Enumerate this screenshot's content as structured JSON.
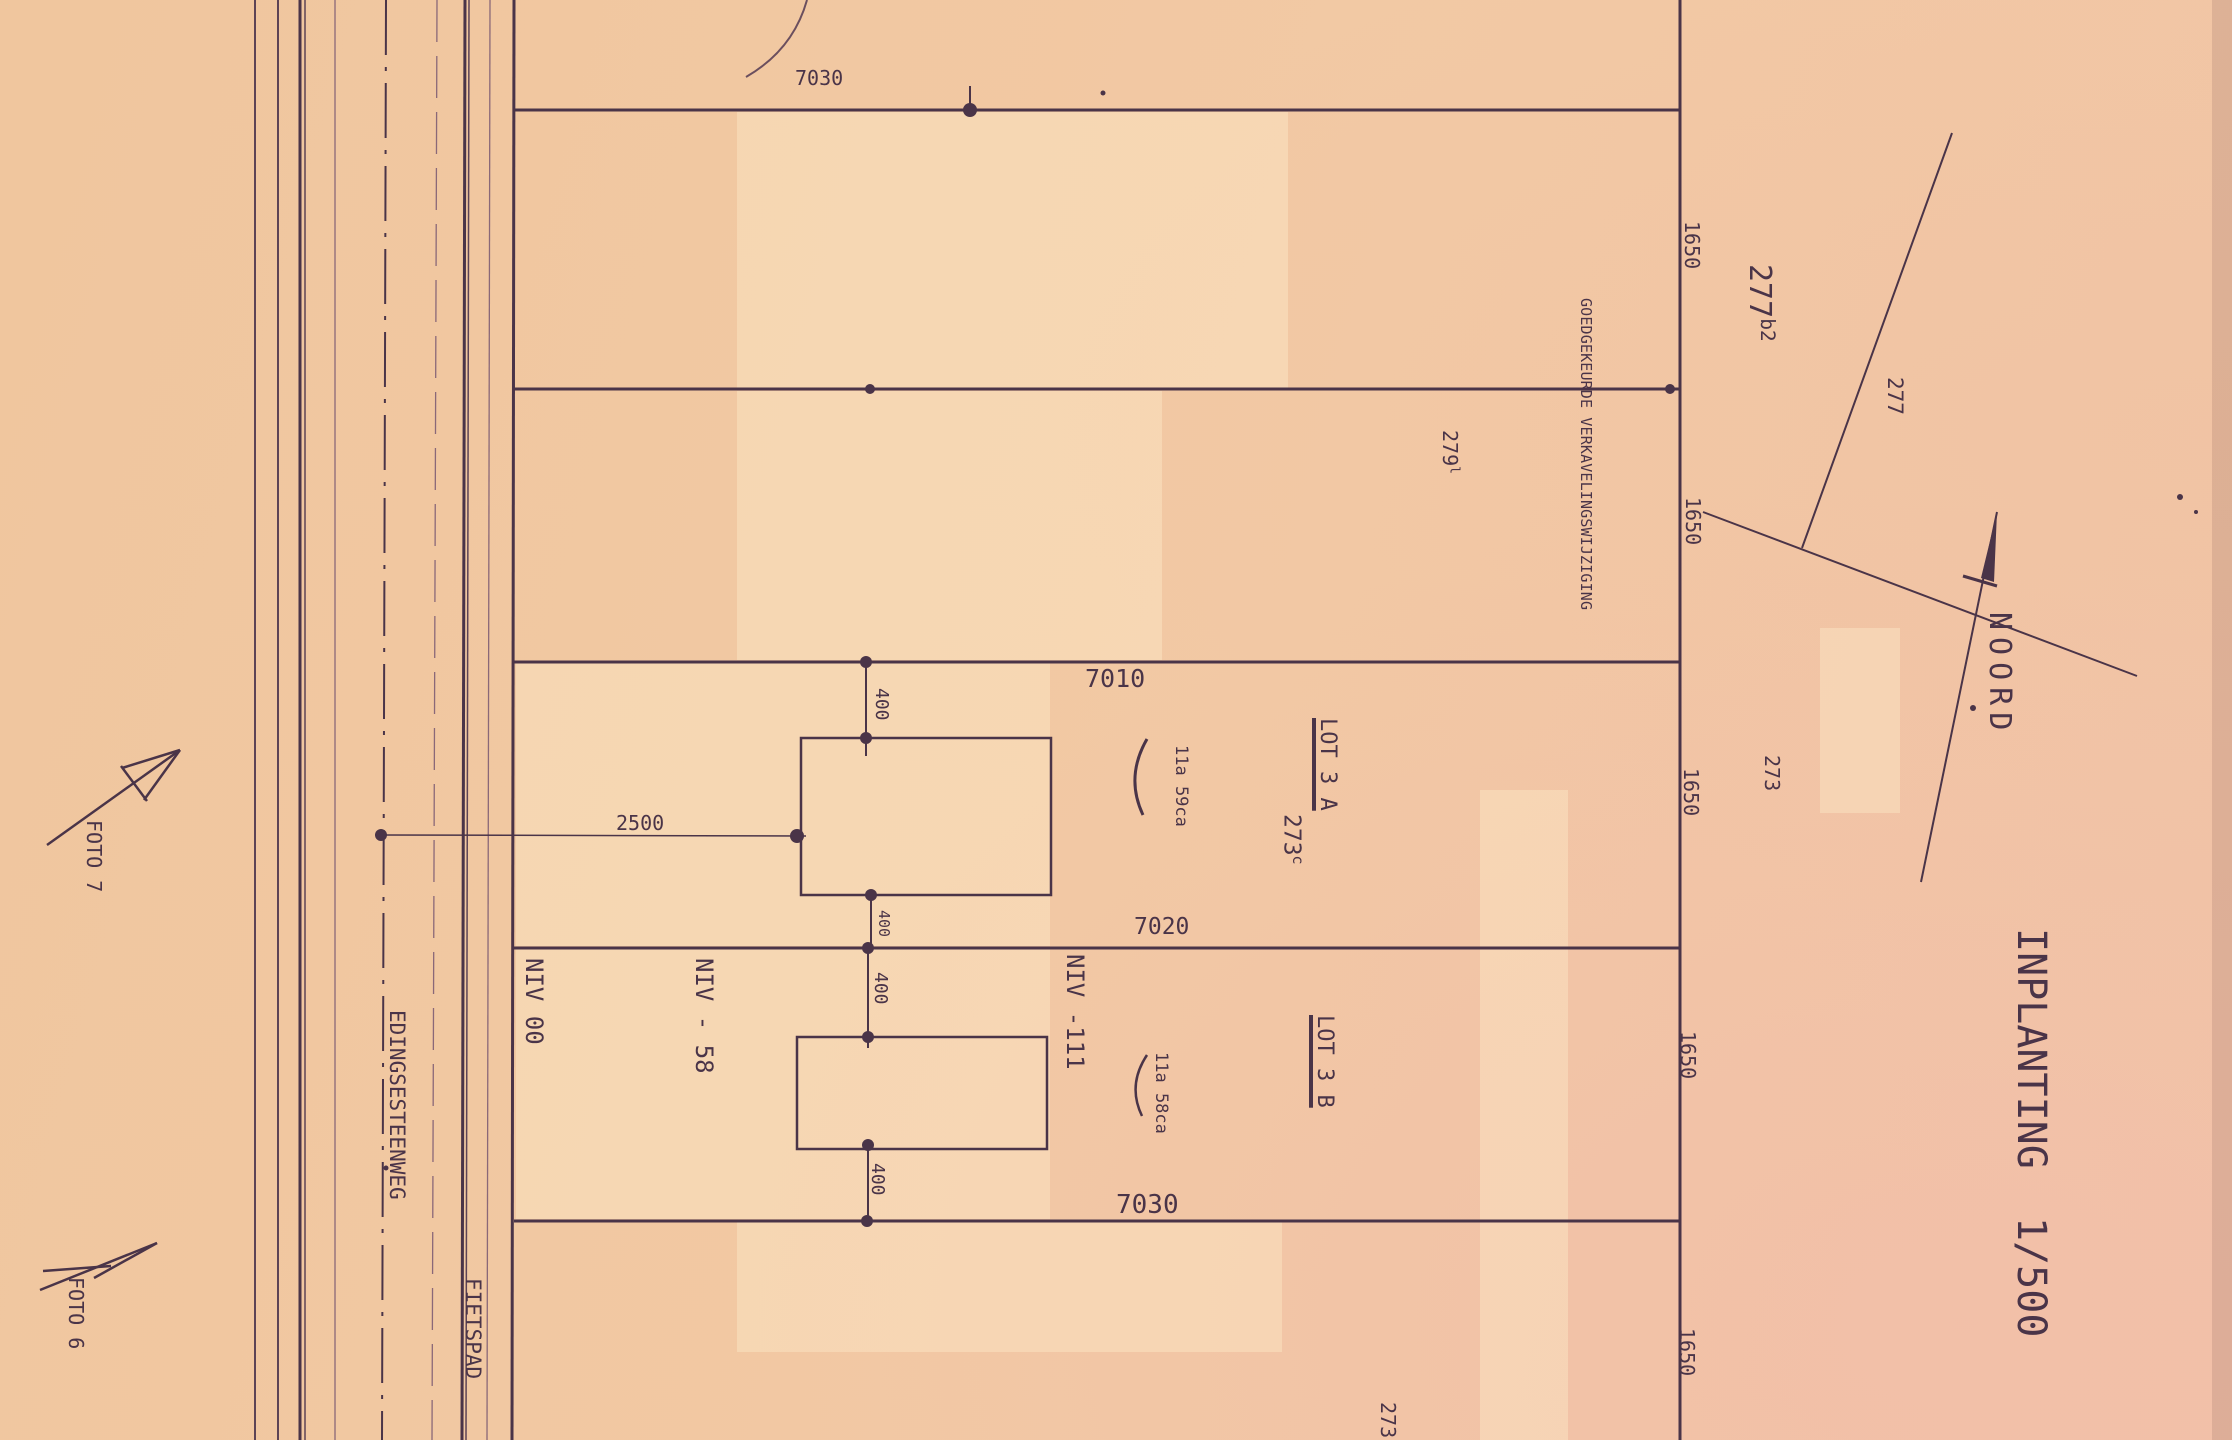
{
  "sheet": {
    "title": "INPLANTING  1/500",
    "north_label": "NOORD",
    "approval_note": "GOEDGEKEURDE VERKAVELINGSWIJZIGING"
  },
  "roads": {
    "street_name": "EDINGSESTEENWEG",
    "cycle_path_label": "FIETSPAD"
  },
  "photo_markers": {
    "foto7": "FOTO 7",
    "foto6": "FOTO 6"
  },
  "lots": {
    "lot_a": {
      "name": "LOT 3 A",
      "area": "11a 59ca",
      "parcel_number": "273",
      "parcel_suffix": "c"
    },
    "lot_b": {
      "name": "LOT 3 B",
      "area": "11a 58ca"
    }
  },
  "levels": {
    "niv_0": "NIV 00",
    "niv_58": "NIV - 58",
    "niv_111": "NIV -111"
  },
  "neighbour_parcels": {
    "p277b2_number": "277",
    "p277b2_suffix": "b2",
    "p277": "277",
    "p279_number": "279",
    "p279_suffix": "l",
    "p273_east": "273",
    "p273_south": "273"
  },
  "dimensions": {
    "line_labels": [
      "7030",
      "7010",
      "7020",
      "7030"
    ],
    "depth_labels": [
      "1650",
      "1650",
      "1650",
      "1650",
      "1650"
    ],
    "setback_labels": [
      "400",
      "400",
      "400",
      "400"
    ],
    "road_offset": "2500"
  }
}
